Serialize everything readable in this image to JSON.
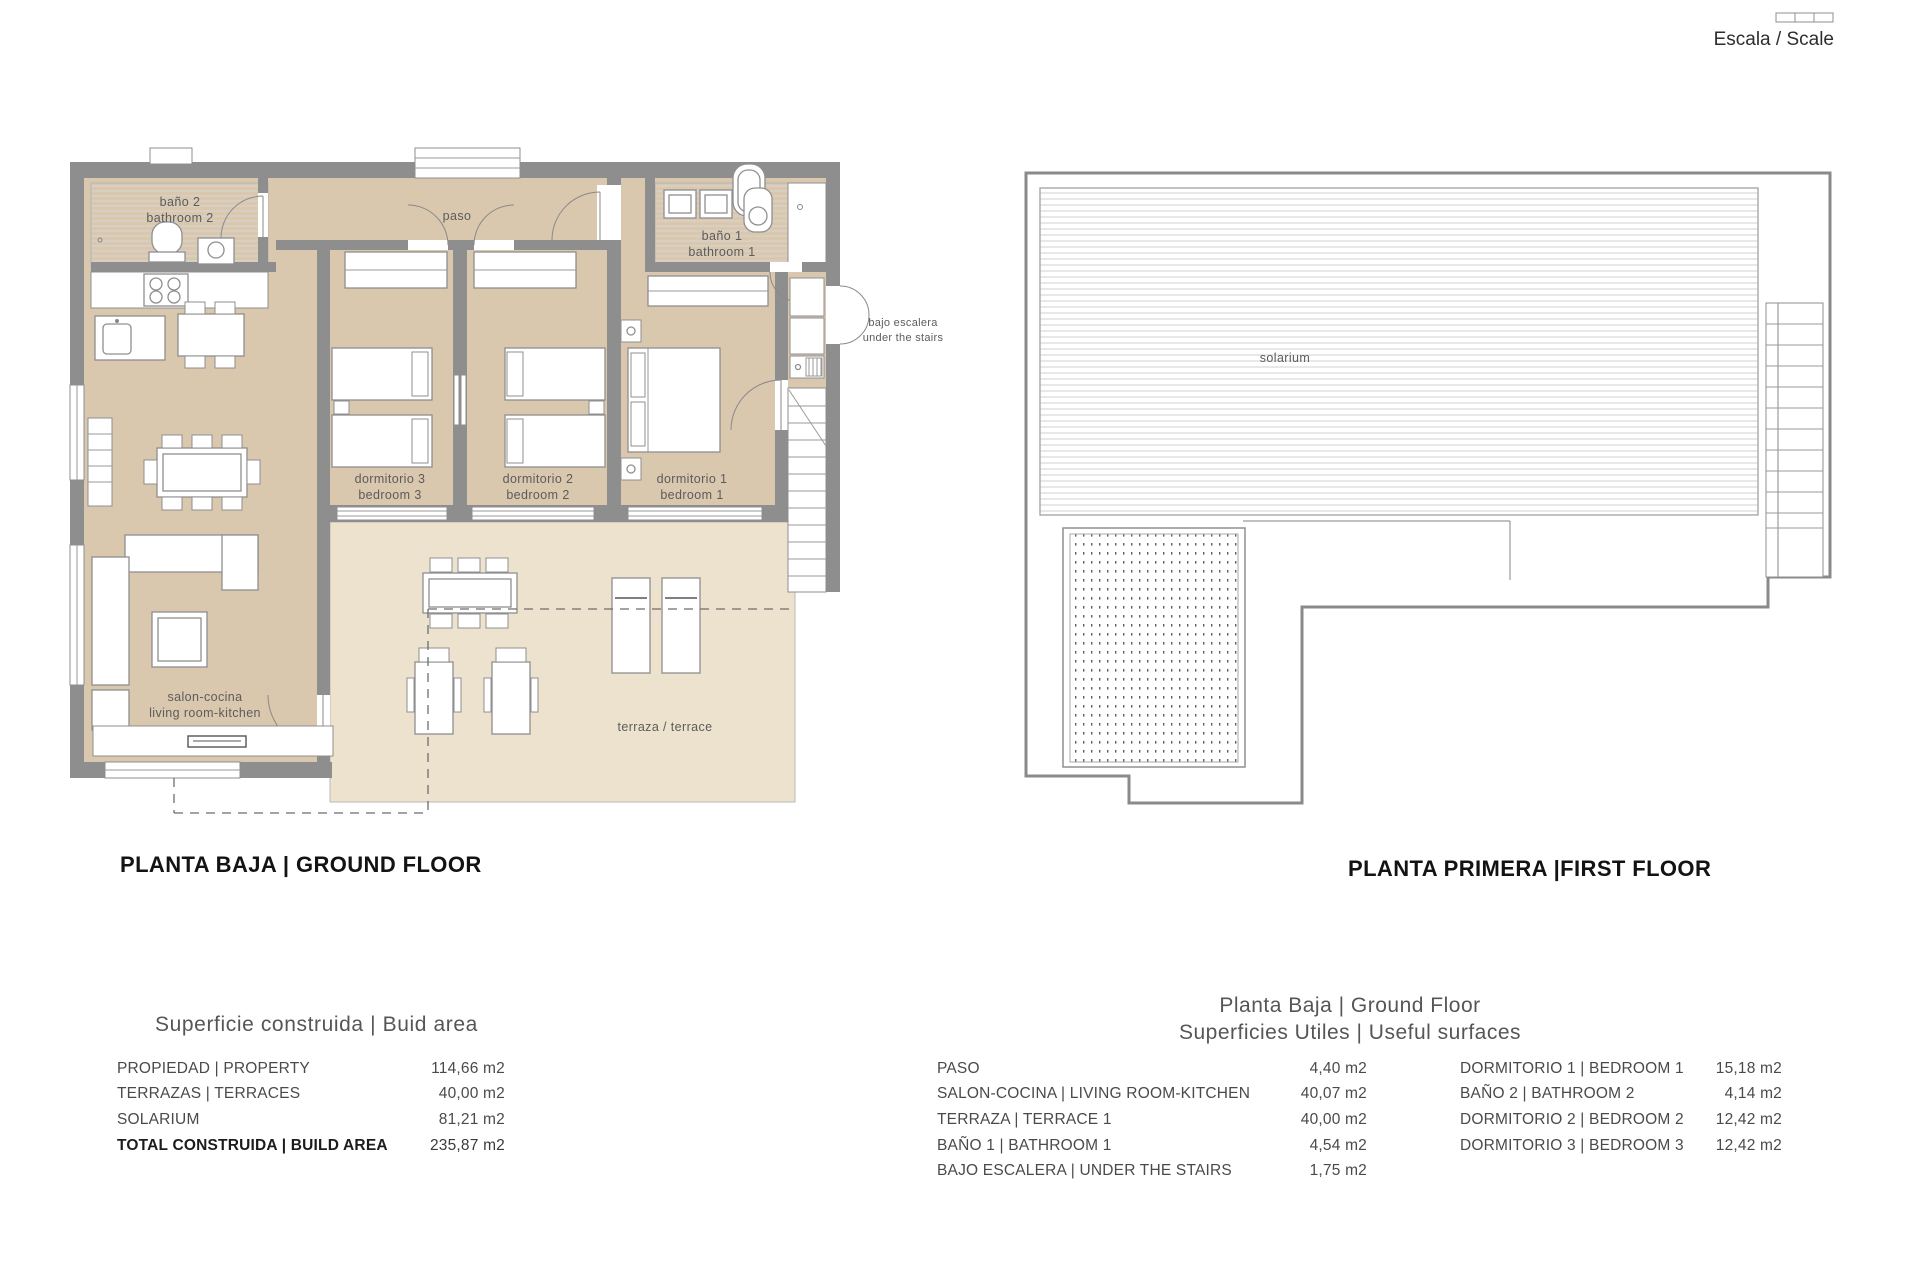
{
  "scale": {
    "label": "Escala / Scale"
  },
  "ground_floor": {
    "title": "PLANTA BAJA | GROUND FLOOR",
    "labels": {
      "bano2_1": "baño 2",
      "bano2_2": "bathroom 2",
      "paso": "paso",
      "bano1_1": "baño 1",
      "bano1_2": "bathroom 1",
      "dorm3_1": "dormitorio 3",
      "dorm3_2": "bedroom 3",
      "dorm2_1": "dormitorio 2",
      "dorm2_2": "bedroom 2",
      "dorm1_1": "dormitorio 1",
      "dorm1_2": "bedroom 1",
      "salon_1": "salon-cocina",
      "salon_2": "living room-kitchen",
      "terraza": "terraza / terrace",
      "bajo_1": "bajo escalera",
      "bajo_2": "under the stairs"
    }
  },
  "first_floor": {
    "title": "PLANTA PRIMERA |FIRST FLOOR",
    "labels": {
      "solarium": "solarium"
    }
  },
  "build_area_table": {
    "title": "Superficie construida | Buid area",
    "rows": [
      {
        "label": "PROPIEDAD | PROPERTY",
        "value": "114,66 m2"
      },
      {
        "label": "TERRAZAS | TERRACES",
        "value": "40,00 m2"
      },
      {
        "label": "SOLARIUM",
        "value": "81,21 m2"
      },
      {
        "label": "TOTAL CONSTRUIDA | BUILD AREA",
        "value": "235,87 m2"
      }
    ]
  },
  "useful_table": {
    "title_line1": "Planta Baja | Ground Floor",
    "title_line2": "Superficies Utiles | Useful surfaces",
    "left_rows": [
      {
        "label": "PASO",
        "value": "4,40 m2"
      },
      {
        "label": "SALON-COCINA | LIVING ROOM-KITCHEN",
        "value": "40,07 m2"
      },
      {
        "label": "TERRAZA | TERRACE 1",
        "value": "40,00 m2"
      },
      {
        "label": "BAÑO 1 | BATHROOM 1",
        "value": "4,54 m2"
      },
      {
        "label": "BAJO ESCALERA | UNDER THE STAIRS",
        "value": "1,75 m2"
      }
    ],
    "right_rows": [
      {
        "label": "DORMITORIO 1 | BEDROOM 1",
        "value": "15,18 m2"
      },
      {
        "label": "BAÑO 2 | BATHROOM 2",
        "value": "4,14 m2"
      },
      {
        "label": "DORMITORIO 2 | BEDROOM 2",
        "value": "12,42 m2"
      },
      {
        "label": "DORMITORIO 3 | BEDROOM 3",
        "value": "12,42 m2"
      }
    ]
  }
}
